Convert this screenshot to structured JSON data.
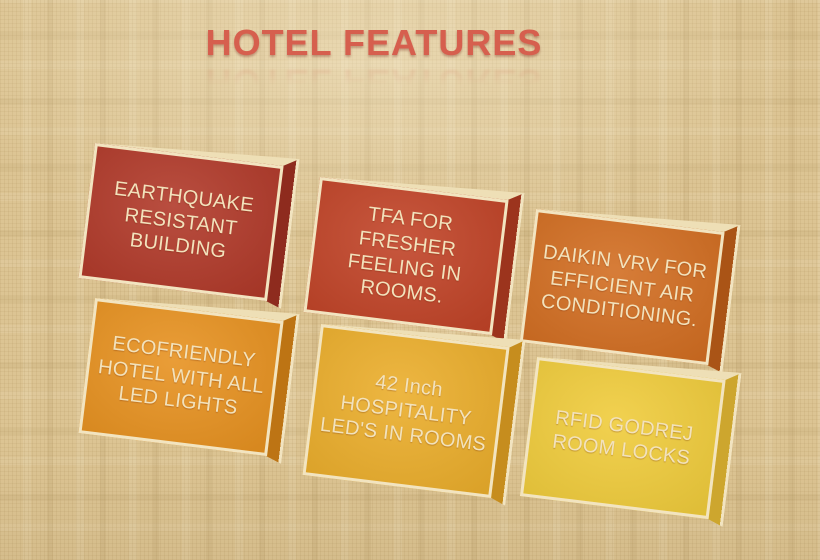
{
  "slide": {
    "title": "HOTEL FEATURES",
    "title_color": "#d65f4e",
    "background_base": "#dcc493",
    "edge_color": "#f2e4c0",
    "edge_dim_color": "#eedfb6",
    "label_color": "#f2e2bc"
  },
  "features": [
    {
      "id": "earthquake-resistant-building",
      "label": "EARTHQUAKE\nRESISTANT\nBUILDING",
      "face_color": "#b13a2a",
      "side_color": "#8e2b1e"
    },
    {
      "id": "tfa-fresher-feeling-rooms",
      "label": "TFA FOR\nFRESHER\nFEELING IN\nROOMS.",
      "face_color": "#c14428",
      "side_color": "#9c341d"
    },
    {
      "id": "daikin-vrv-air-conditioning",
      "label": "DAIKIN VRV FOR\nEFFICIENT AIR\nCONDITIONING.",
      "face_color": "#d26e22",
      "side_color": "#aa5416"
    },
    {
      "id": "ecofriendly-led-lights",
      "label": "ECOFRIENDLY\nHOTEL WITH ALL\nLED LIGHTS",
      "face_color": "#e79221",
      "side_color": "#bd7414"
    },
    {
      "id": "hospitality-led-tv-rooms",
      "label": "42 Inch\nHOSPITALITY\nLED'S IN ROOMS",
      "face_color": "#ebae2c",
      "side_color": "#c68d1e"
    },
    {
      "id": "rfid-godrej-room-locks",
      "label": "RFID GODREJ\nROOM LOCKS",
      "face_color": "#f0cc3c",
      "side_color": "#cda62e"
    }
  ]
}
